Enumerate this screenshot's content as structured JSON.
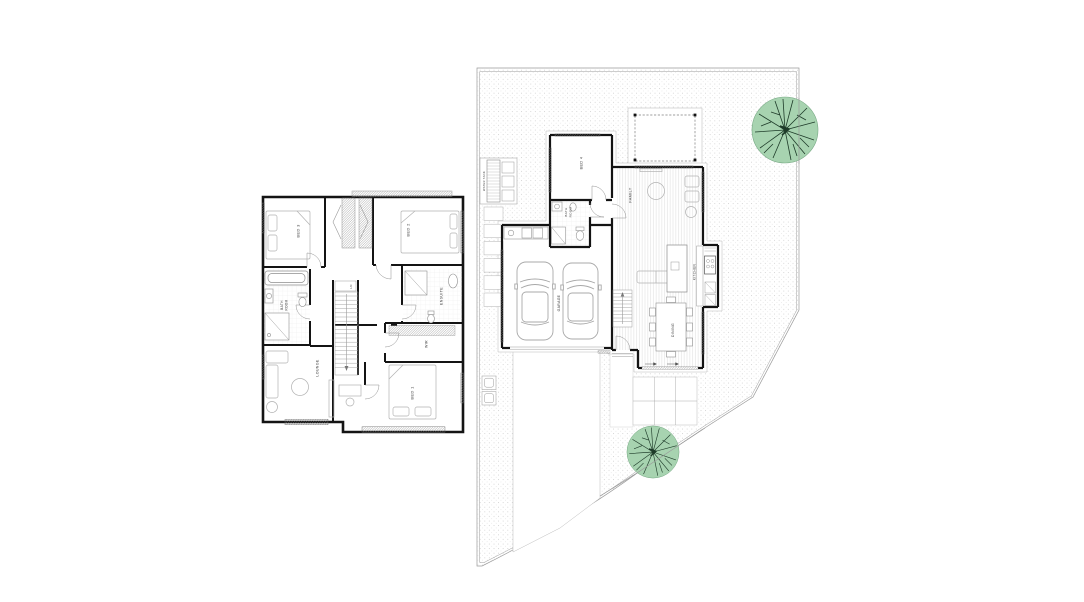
{
  "title": "Two storey house floor plan and site plan",
  "colors": {
    "background": "#ffffff",
    "wall": "#141414",
    "boundary_line": "#9a9a9a",
    "ground_dots": "#c2c2c2",
    "timber_floor_line": "#dcdcdc",
    "tree_fill": "#a7d3b0",
    "tree_branches": "#1e3b29",
    "furniture_line": "#b2b2b2"
  },
  "upper_floor": {
    "rooms": [
      {
        "label": "BED 3"
      },
      {
        "label": "BED 2"
      },
      {
        "label": "BATH ROOM",
        "line1": "BATH",
        "line2": "ROOM"
      },
      {
        "label": "ENSUITE"
      },
      {
        "label": "LN"
      },
      {
        "label": "WIR"
      },
      {
        "label": "LOUNGE"
      },
      {
        "label": "BED 1"
      }
    ]
  },
  "ground_floor": {
    "rooms": [
      {
        "label": "BED 4"
      },
      {
        "label": "BATH ROOM",
        "line1": "BATH",
        "line2": "ROOM"
      },
      {
        "label": "FAMILY"
      },
      {
        "label": "KITCHEN"
      },
      {
        "label": "GARAGE"
      },
      {
        "label": "DINING"
      }
    ],
    "site": {
      "water_tank_label": "WATER TANK",
      "tree_count": 2,
      "car_count": 2
    }
  }
}
